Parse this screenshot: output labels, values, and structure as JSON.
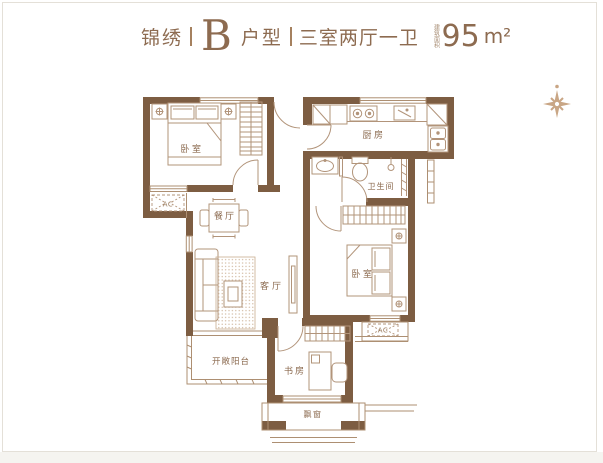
{
  "header": {
    "brand": "锦绣",
    "divider": "|",
    "unit_letter": "B",
    "unit_word": "户型",
    "layout_desc": "三室两厅一卫",
    "area_label": "建筑面积",
    "area_value": "95",
    "area_unit": "m²"
  },
  "plan": {
    "rooms": {
      "bedroom1": "卧室",
      "kitchen": "厨房",
      "bathroom": "卫生间",
      "dining": "餐厅",
      "living": "客厅",
      "bedroom2": "卧室",
      "balcony": "开敞阳台",
      "study": "书房",
      "bay_window": "飘窗",
      "ac1": "AC",
      "ac2": "AC"
    }
  },
  "colors": {
    "wall": "#7d5d42",
    "furniture_line": "#b2947a",
    "window_line": "#ad8f72",
    "room_label": "#8a684d",
    "header_text": "#8d6b50",
    "compass": "#c9a685",
    "frame_border": "#e4e0d8"
  }
}
